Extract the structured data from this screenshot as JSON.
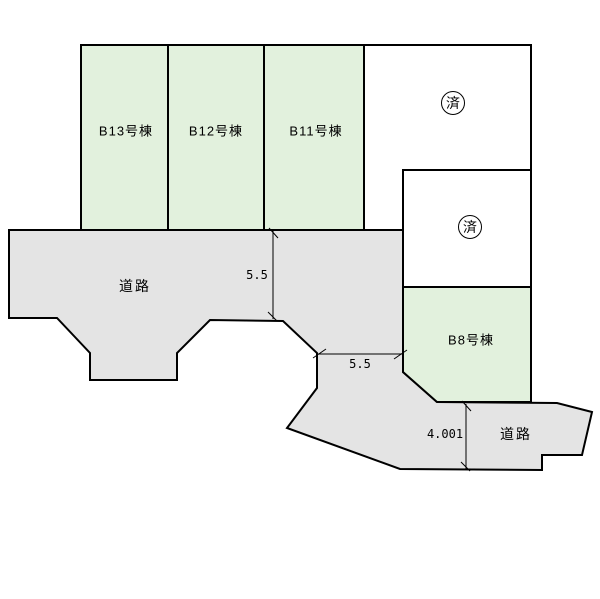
{
  "plots": [
    {
      "label": "B13号棟",
      "status": "available"
    },
    {
      "label": "B12号棟",
      "status": "available"
    },
    {
      "label": "B11号棟",
      "status": "available"
    },
    {
      "label": "B8号棟",
      "status": "available"
    }
  ],
  "sold_marks": [
    {
      "label": "済"
    },
    {
      "label": "済"
    }
  ],
  "roads": [
    {
      "label": "道路",
      "position": "left"
    },
    {
      "label": "道路",
      "position": "bottom-right"
    }
  ],
  "dimensions": [
    {
      "value": "5.5",
      "orientation": "vertical"
    },
    {
      "value": "5.5",
      "orientation": "horizontal"
    },
    {
      "value": "4.001",
      "orientation": "vertical"
    }
  ],
  "colors": {
    "plot_available": "#e2f1dd",
    "plot_sold": "#ffffff",
    "road": "#e4e4e4",
    "outline": "#000000"
  }
}
